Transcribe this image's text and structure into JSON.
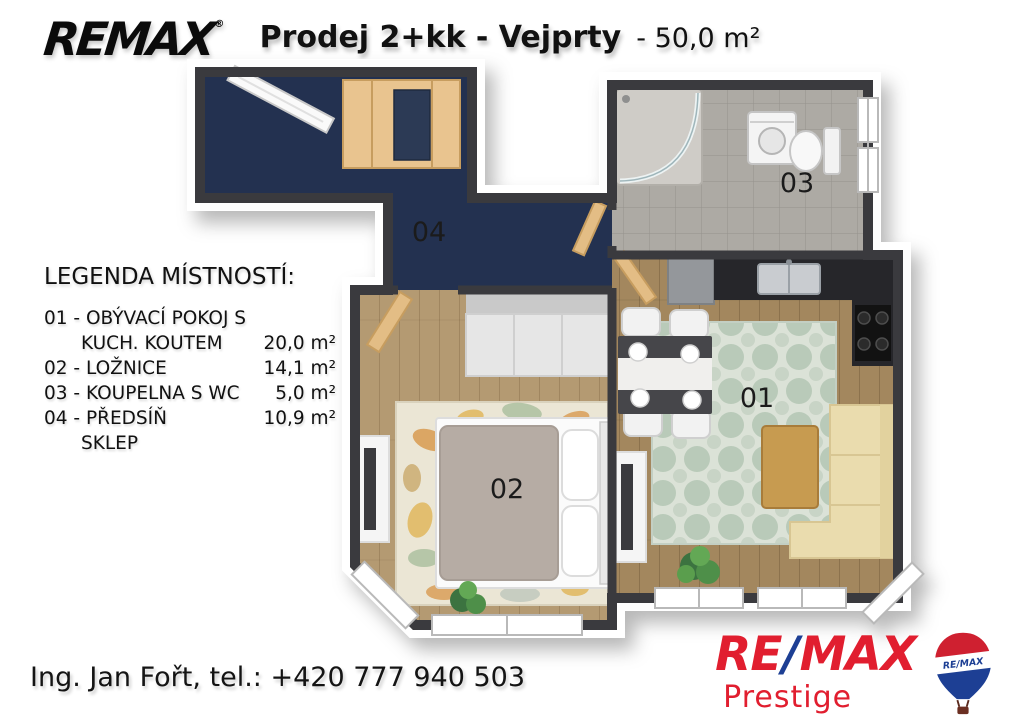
{
  "header": {
    "brand_logo": "REMAX",
    "brand_trademark": "®",
    "title_bold": "Prodej 2+kk - Vejprty",
    "title_regular": "- 50,0 m²"
  },
  "legend": {
    "title": "LEGENDA MÍSTNOSTÍ:",
    "rows": [
      {
        "text": "01 - OBÝVACÍ POKOJ S",
        "area": ""
      },
      {
        "text": "KUCH. KOUTEM",
        "area": "20,0 m²"
      },
      {
        "text": "02 - LOŽNICE",
        "area": "14,1 m²"
      },
      {
        "text": "03 - KOUPELNA S WC",
        "area": "5,0 m²"
      },
      {
        "text": "04 - PŘEDSÍŇ",
        "area": "10,9 m²"
      },
      {
        "text": "SKLEP",
        "area": ""
      }
    ]
  },
  "floorplan": {
    "room_labels": {
      "living": "01",
      "bedroom": "02",
      "bathroom": "03",
      "hallway": "04"
    }
  },
  "footer": {
    "contact": "Ing. Jan Fořt, tel.: +420 777 940 503",
    "agency_brand_re": "RE",
    "agency_brand_slash": "/",
    "agency_brand_max": "MAX",
    "agency_name": "Prestige",
    "balloon_label": "RE/MAX"
  },
  "colors": {
    "remax_red": "#e11e2f",
    "remax_blue": "#1d3f94",
    "wall_dark": "#3a3a3e",
    "floor_hall_navy": "#233150",
    "floor_living_wood": "#a3875e",
    "floor_bedroom_wood": "#b49a72",
    "floor_bath_tile": "#adaaa4",
    "rug_sage": "#dbe2d7",
    "rug_sage_motif": "#b9cab9",
    "rug_bedroom_cream": "#ebe6d5",
    "sofa_beige": "#eadcae",
    "furniture_wood": "#e9c48f",
    "coffee_table_wood": "#c79b50"
  }
}
